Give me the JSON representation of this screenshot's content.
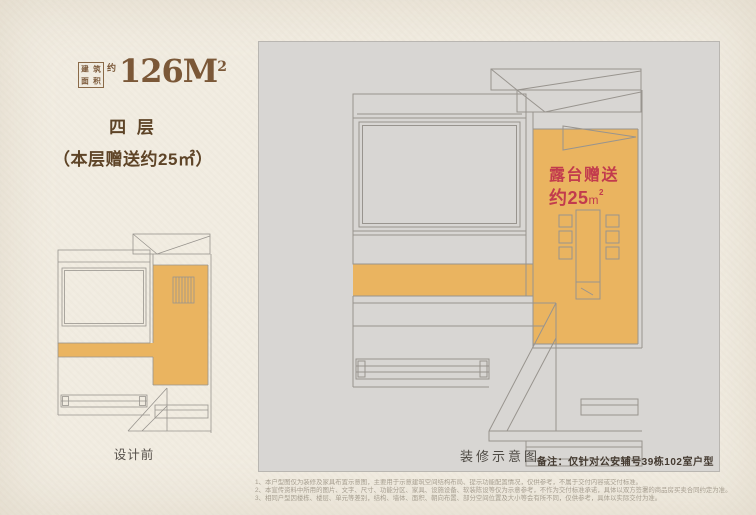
{
  "page": {
    "width": 756,
    "height": 515
  },
  "colors": {
    "paper": "#f1ece1",
    "panel_gray": "#d8d6d3",
    "terrace_orange": "#eab460",
    "accent_red": "#c23b4d",
    "title_brown": "#7b5838",
    "text_dark_brown": "#5e4427",
    "plan_line_gray": "#98948e"
  },
  "header": {
    "area_box_chars": [
      "建",
      "筑",
      "面",
      "积"
    ],
    "area_approx": "约",
    "area_value": "126M",
    "area_sup": "2",
    "floor_label": "四 层",
    "bonus_note": "（本层赠送约25㎡）"
  },
  "small_plan": {
    "caption": "设计前"
  },
  "large_plan": {
    "caption": "装修示意图",
    "terrace_line1": "露台赠送",
    "terrace_line2": "约25",
    "terrace_unit": "m",
    "terrace_unit_sup": "2",
    "note": "备注：仅针对公安辅号39栋102室户型"
  },
  "footnotes": [
    "1、本户型图仅为装修及家具布置示意图，主要用于示意建筑空间结构布局、提示功能配置情况，仅供参考，不属于交付内容或交付标准。",
    "2、本宣传资料中所用的图片、文字、尺寸、功能分区、家具、设施设备、软装陈设等仅为示意参考，不作为交付标准承诺，具体以双方签署的商品房买卖合同约定为准。",
    "3、相同户型因楼栋、楼层、单元等差别，结构、墙体、面积、朝向布置、部分空间位置及大小等会有所不同，仅供参考，具体以实际交付为准。"
  ]
}
